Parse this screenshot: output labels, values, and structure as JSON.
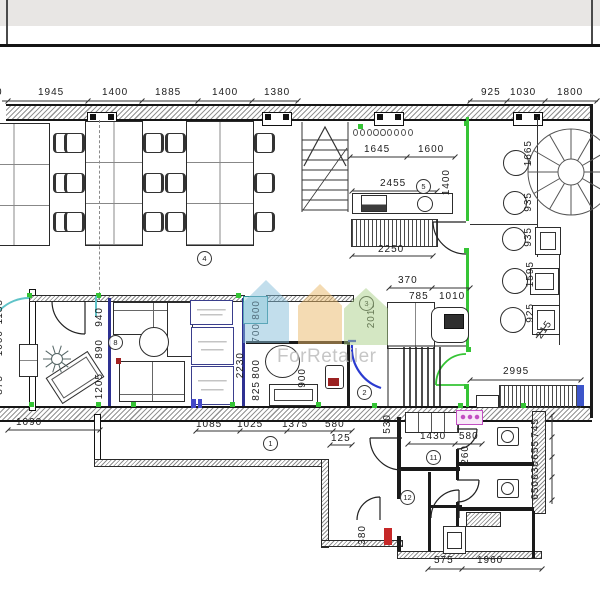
{
  "watermark": {
    "brand": "ForRetailer"
  },
  "colors": {
    "green_wall": "#35c435",
    "blue_wall": "#2e3192",
    "cyan_door": "#5fc3c8",
    "blue_door": "#2b3bd0",
    "teal_box": "#2f8f96",
    "pink_fixture": "#c24fc2",
    "red_fixture": "#c62828",
    "watermark_gray": "#bdbdbd"
  },
  "dims": {
    "top_left": [
      "0",
      "1945",
      "1400",
      "1885",
      "1400",
      "1380"
    ],
    "top_right": [
      "925",
      "1030",
      "1800"
    ],
    "kitchen": [
      "1645",
      "1600",
      "1400",
      "2455",
      "2250"
    ],
    "cabinet_room": [
      "370",
      "785",
      "1010",
      "2010"
    ],
    "cafe": [
      "1665",
      "935",
      "935",
      "1595",
      "925",
      "215",
      "2995"
    ],
    "lounge": [
      "940",
      "890",
      "1205"
    ],
    "lounge_left": [
      "1185",
      "1000",
      "875"
    ],
    "wc": [
      "800",
      "700",
      "800",
      "825",
      "2230",
      "900"
    ],
    "bottom": [
      "1090",
      "1085",
      "1025",
      "1375",
      "580",
      "125"
    ],
    "service": [
      "530",
      "1430",
      "580",
      "260",
      "745",
      "655",
      "630",
      "650",
      "380",
      "575",
      "1960"
    ]
  },
  "rooms": {
    "r1": "1",
    "r2": "2",
    "r3": "3",
    "r4": "4",
    "r5": "5",
    "r8": "8",
    "r11": "11",
    "r12": "12"
  }
}
